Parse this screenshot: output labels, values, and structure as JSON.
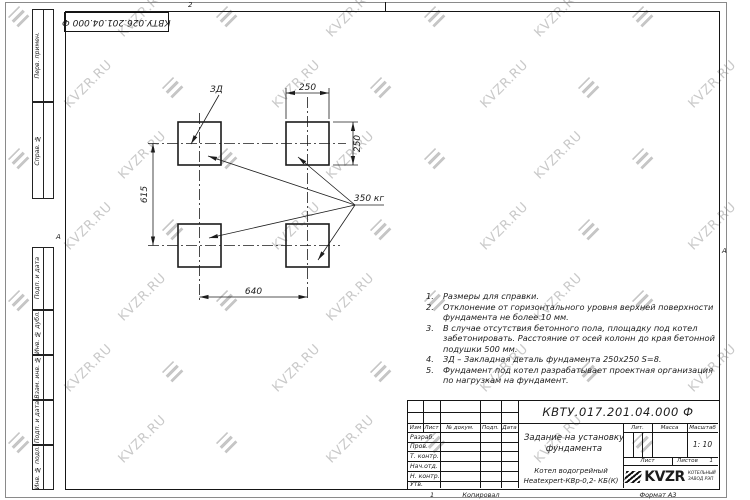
{
  "watermark": {
    "text": "KVZR.RU"
  },
  "corner_stamp": {
    "doc_number": "КВТУ.026.201.04.000 Ф"
  },
  "zones": {
    "top": "2",
    "left": "А",
    "right": "А"
  },
  "margin_labels": [
    "Перв. примен.",
    "Справ. №",
    "Подп. и дата",
    "Инв. № дубл.",
    "Взам. инв. №",
    "Подп. и дата",
    "Инв. № подл."
  ],
  "drawing": {
    "detail_label": "ЗД",
    "load_label": "350 кг",
    "dim_width_top": "250",
    "dim_height_right": "250",
    "dim_span_vertical": "615",
    "dim_span_horizontal": "640"
  },
  "notes": [
    {
      "num": "1.",
      "text": "Размеры для справки."
    },
    {
      "num": "2.",
      "text": "Отклонение от горизонтального уровня верхней поверхности фундамента не более 10 мм."
    },
    {
      "num": "3.",
      "text": "В случае отсутствия бетонного пола, площадку под котел забетонировать. Расстояние от осей колонн до края бетонной подушки 500 мм."
    },
    {
      "num": "4.",
      "text": "ЗД – Закладная деталь фундамента 250х250 S=8."
    },
    {
      "num": "5.",
      "text": "Фундамент под котел разрабатывает проектная организация по нагрузкам на фундамент."
    }
  ],
  "title_block": {
    "doc_number": "КВТУ.017.201.04.000 Ф",
    "doc_title": "Задание на установку фундамента",
    "product_line1": "Котел водогрейный",
    "product_line2": "Heatexpert-КВр-0,2- КБ(К)",
    "rev_cols": [
      "Изм",
      "Лист",
      "№ докум.",
      "Подп.",
      "Дата"
    ],
    "sig_rows": [
      "Разраб.",
      "Пров.",
      "Т. контр.",
      "Нач.отд.",
      "Н. контр.",
      "Утв."
    ],
    "lit_label": "Лит.",
    "mass_label": "Масса",
    "scale_label": "Масштаб",
    "scale_value": "1: 10",
    "sheet_label": "Лист",
    "sheets_label": "Листов",
    "sheets_value": "1",
    "company": {
      "logo_text": "KVZR",
      "tagline_line1": "КОТЕЛЬНЫЙ",
      "tagline_line2": "ЗАВОД РЭП"
    }
  },
  "footer": {
    "zone": "1",
    "copied_label": "Копировал",
    "format_label": "Формат А3"
  }
}
